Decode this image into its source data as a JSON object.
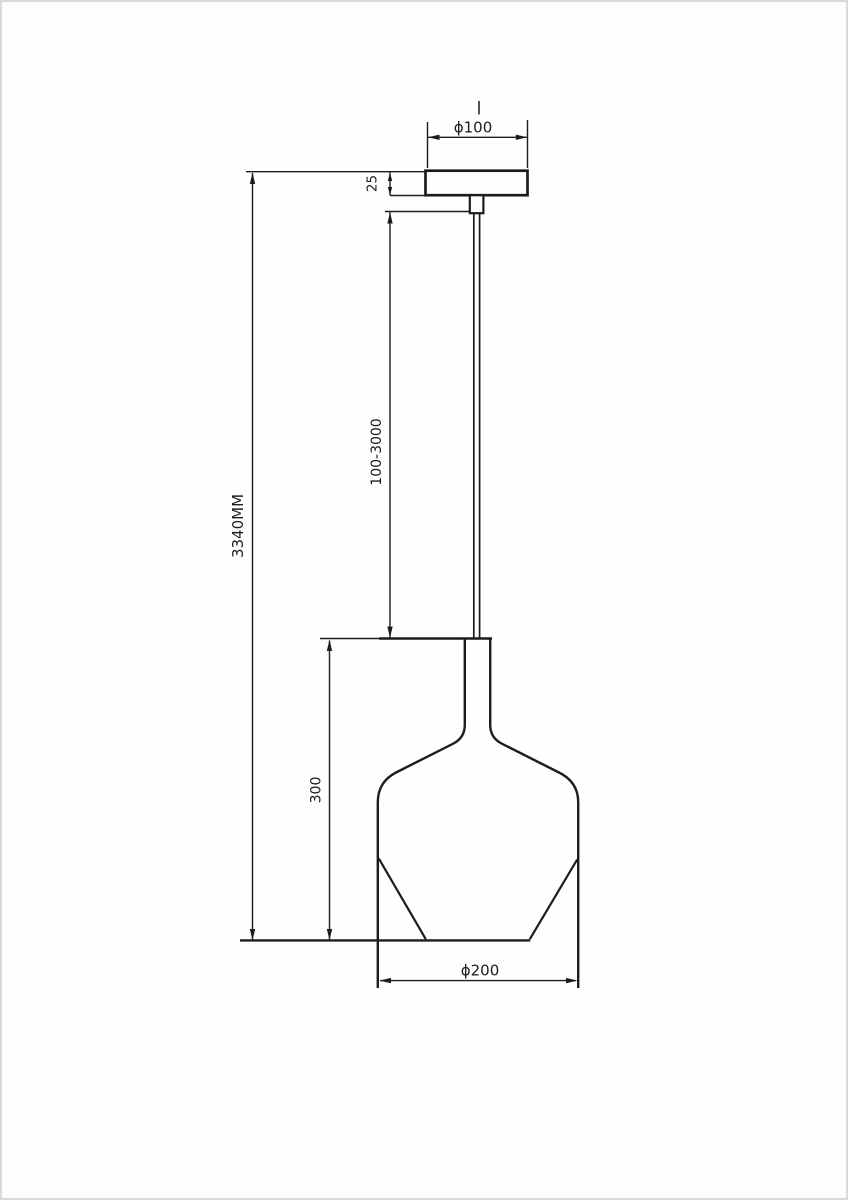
{
  "drawing": {
    "type": "pendant-lamp-dimension-drawing",
    "labels": {
      "canopy_diameter": "ϕ100",
      "canopy_height": "25",
      "suspension_length": "100-3000",
      "total_height": "3340MM",
      "shade_height": "300",
      "shade_diameter": "ϕ200"
    }
  },
  "colors": {
    "line": "#1c1c1c",
    "background": "#fefefe",
    "frame": "#d9d9d9"
  }
}
